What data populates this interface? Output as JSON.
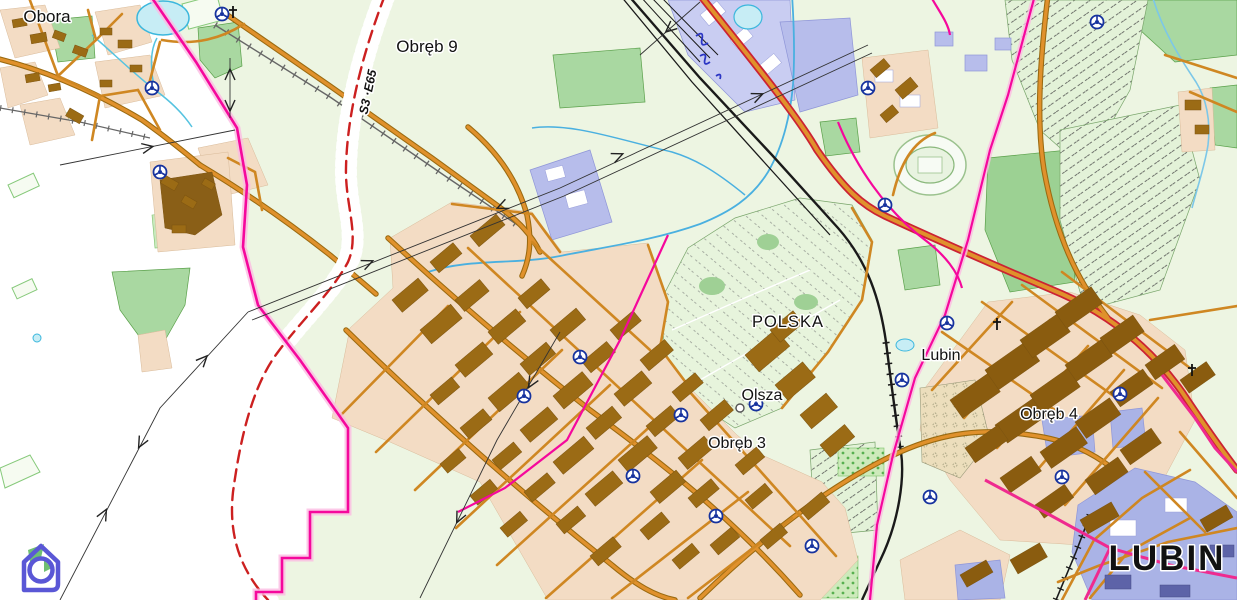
{
  "map": {
    "type": "municipal cadastral / zoning map of Lubin area",
    "labels": {
      "obora": "Obora",
      "obreb9": "Obręb 9",
      "s3_road": "S3 ·E65",
      "polska": "POLSKA",
      "lubin_district": "Lubin",
      "olsza": "Olsza",
      "obreb3": "Obręb 3",
      "obreb4": "Obręb 4",
      "lubin_city": "LUBIN"
    },
    "palette": {
      "background": "#ffffff",
      "terrain": "#edf5e2",
      "forest": "#a9d8a1",
      "park": "#9cd193",
      "urban": "#f3dcc4",
      "building": "#9b6b15",
      "building_dark": "#855a0e",
      "road_orange": "#e0912c",
      "road_casing": "#9a6a10",
      "trunk_red": "#cc2233",
      "expressway_red": "#cc2020",
      "boundary_pink": "#f5089c",
      "railway": "#1a1a1a",
      "water_fill": "#c7edf5",
      "water_line": "#45aede",
      "industrial": "#b9bfea",
      "allotment": "#e3f2d8",
      "junction_blue": "#16329e",
      "logo_blue": "#5a57d6",
      "logo_green": "#6fbf73"
    },
    "icons": {
      "junction": "junction-roundabout-icon",
      "church": "church-cross-icon",
      "power": "power-line-arrow-icon",
      "logo": "house-spiral-logo-icon"
    }
  }
}
